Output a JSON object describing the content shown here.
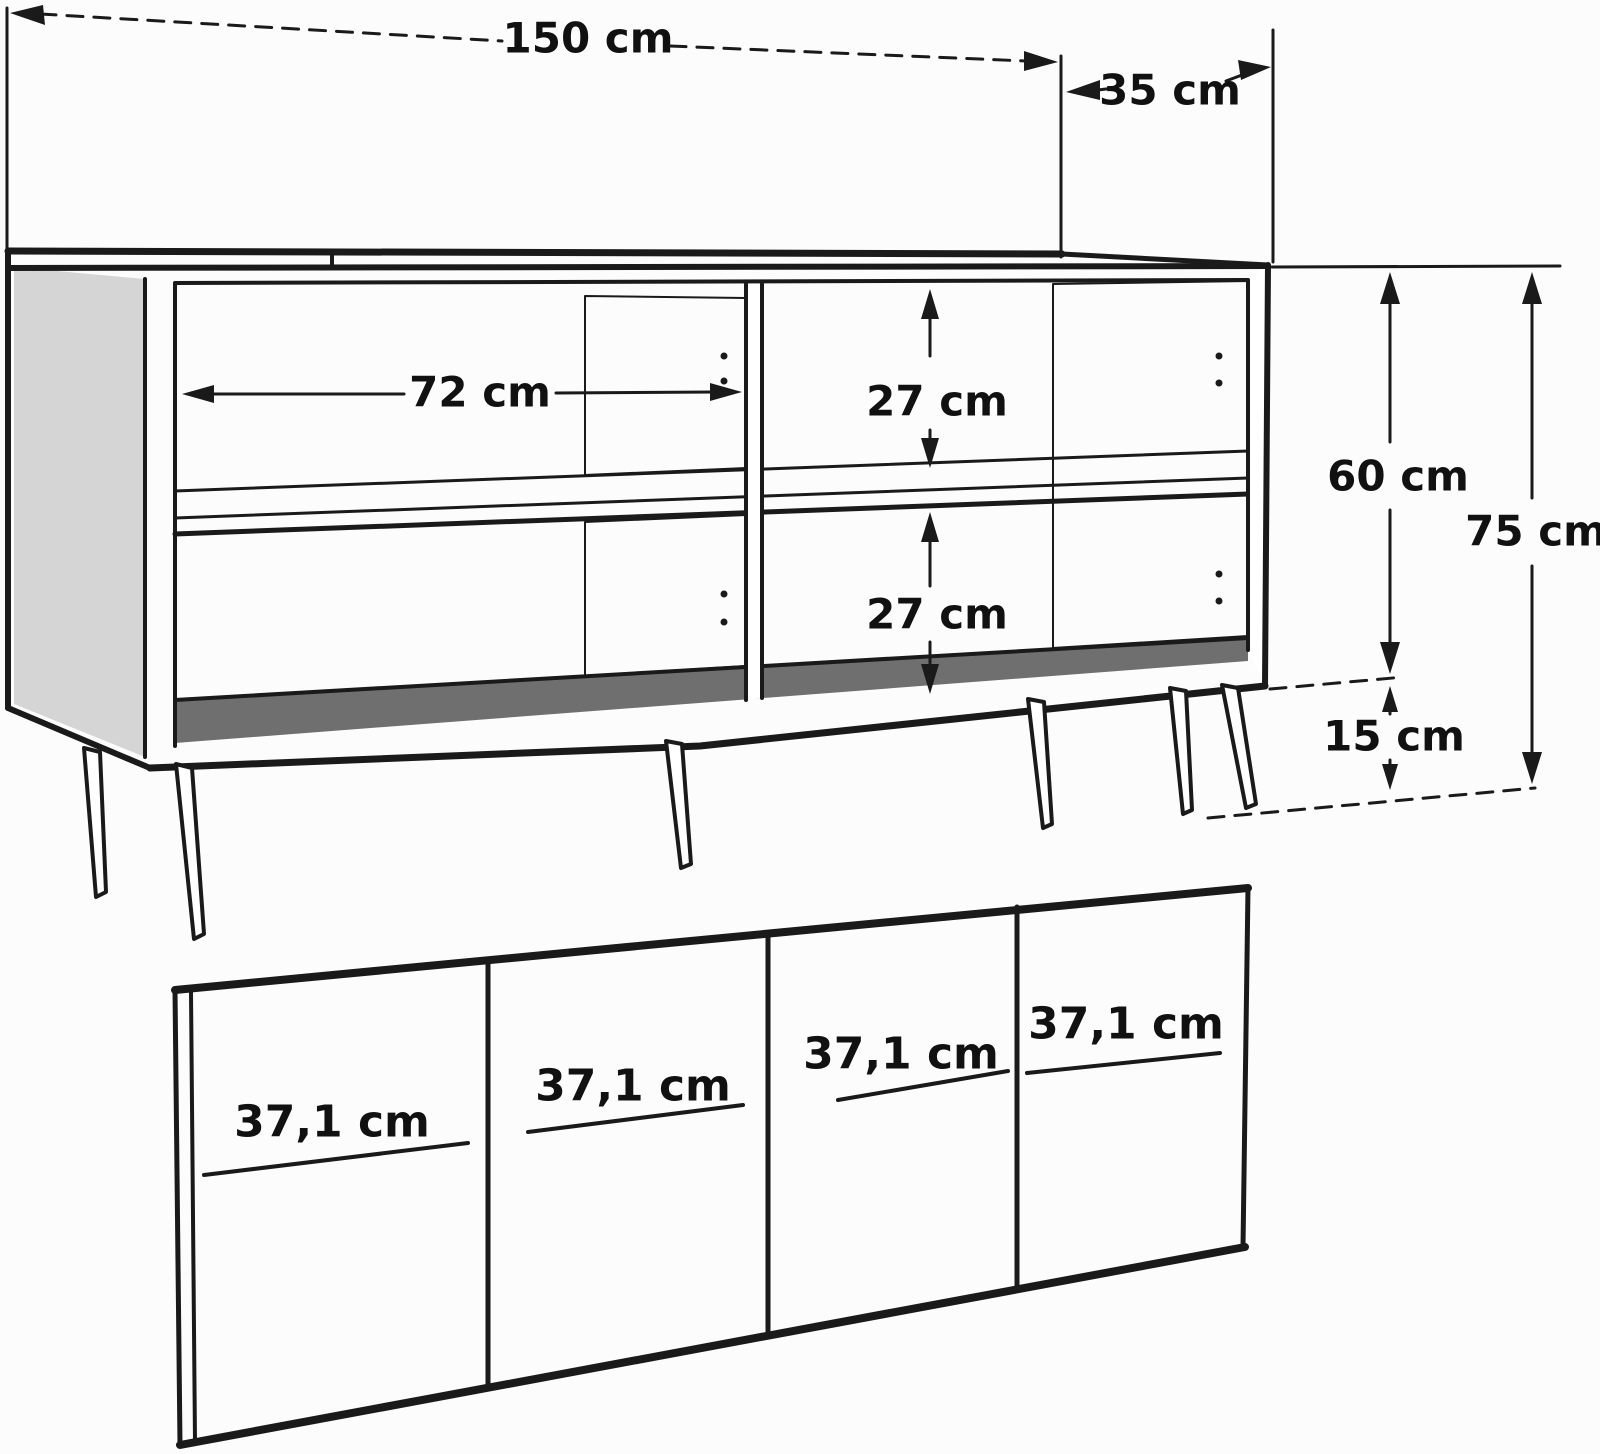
{
  "colors": {
    "line": "#1a1a1a",
    "panel_gray": "#d5d5d5",
    "board_gray": "#6f6f6f",
    "background": "#fcfcfc"
  },
  "cabinet": {
    "total_width": "150 cm",
    "depth": "35 cm",
    "inner_width": "72 cm",
    "upper_compartment_height": "27 cm",
    "lower_compartment_height": "27 cm",
    "body_height": "60 cm",
    "total_height": "75 cm",
    "leg_height": "15 cm"
  },
  "doors": {
    "widths": [
      "37,1 cm",
      "37,1 cm",
      "37,1 cm",
      "37,1 cm"
    ]
  }
}
